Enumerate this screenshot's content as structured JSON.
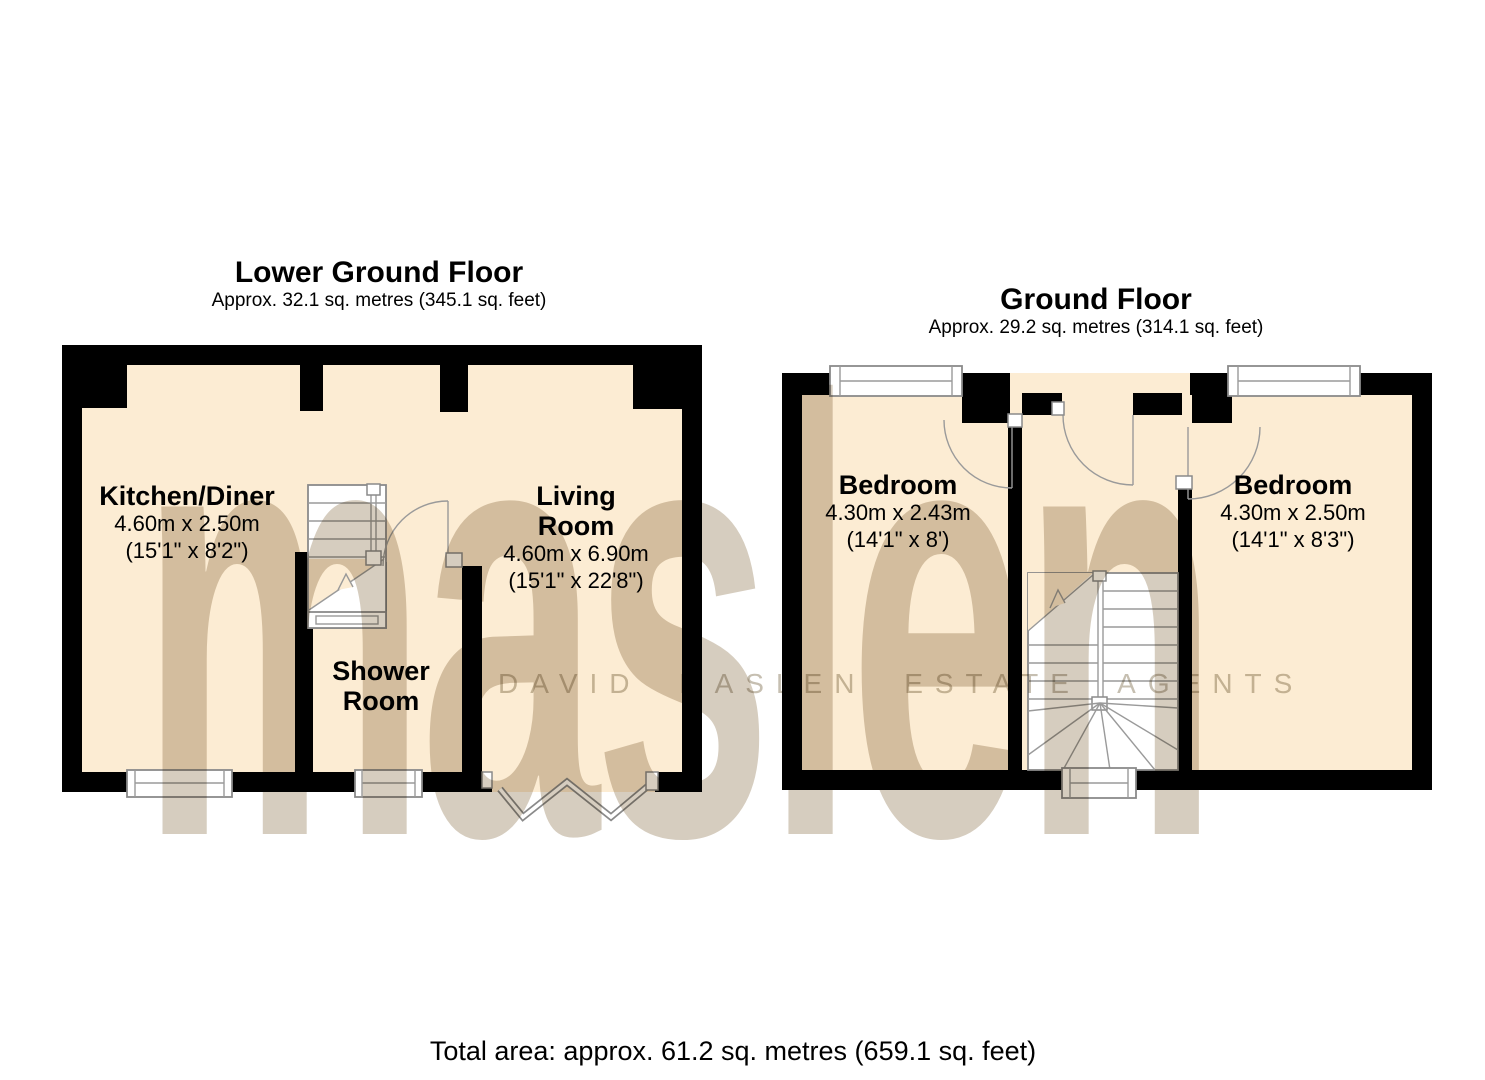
{
  "document": {
    "type": "property-floorplan",
    "total_area": "Total area: approx. 61.2 sq. metres (659.1 sq. feet)"
  },
  "watermark": {
    "logo": "maslen",
    "tagline": "DAVID MASLEN ESTATE AGENTS"
  },
  "colors": {
    "floor_fill": "#fcecd3",
    "wall": "#000000",
    "watermark": "#d6cdbf",
    "background": "#ffffff"
  },
  "floors": [
    {
      "title": "Lower Ground Floor",
      "subtitle": "Approx. 32.1 sq. metres (345.1 sq. feet)",
      "rooms": [
        {
          "name": "Kitchen/Diner",
          "dim_metric": "4.60m x 2.50m",
          "dim_imperial": "(15'1\" x 8'2\")"
        },
        {
          "name": "Living Room",
          "dim_metric": "4.60m x 6.90m",
          "dim_imperial": "(15'1\" x 22'8\")"
        },
        {
          "name": "Shower Room",
          "dim_metric": "",
          "dim_imperial": ""
        }
      ]
    },
    {
      "title": "Ground Floor",
      "subtitle": "Approx. 29.2 sq. metres (314.1 sq. feet)",
      "rooms": [
        {
          "name": "Bedroom",
          "dim_metric": "4.30m x 2.43m",
          "dim_imperial": "(14'1\" x 8')"
        },
        {
          "name": "Bedroom",
          "dim_metric": "4.30m x 2.50m",
          "dim_imperial": "(14'1\" x 8'3\")"
        }
      ]
    }
  ]
}
